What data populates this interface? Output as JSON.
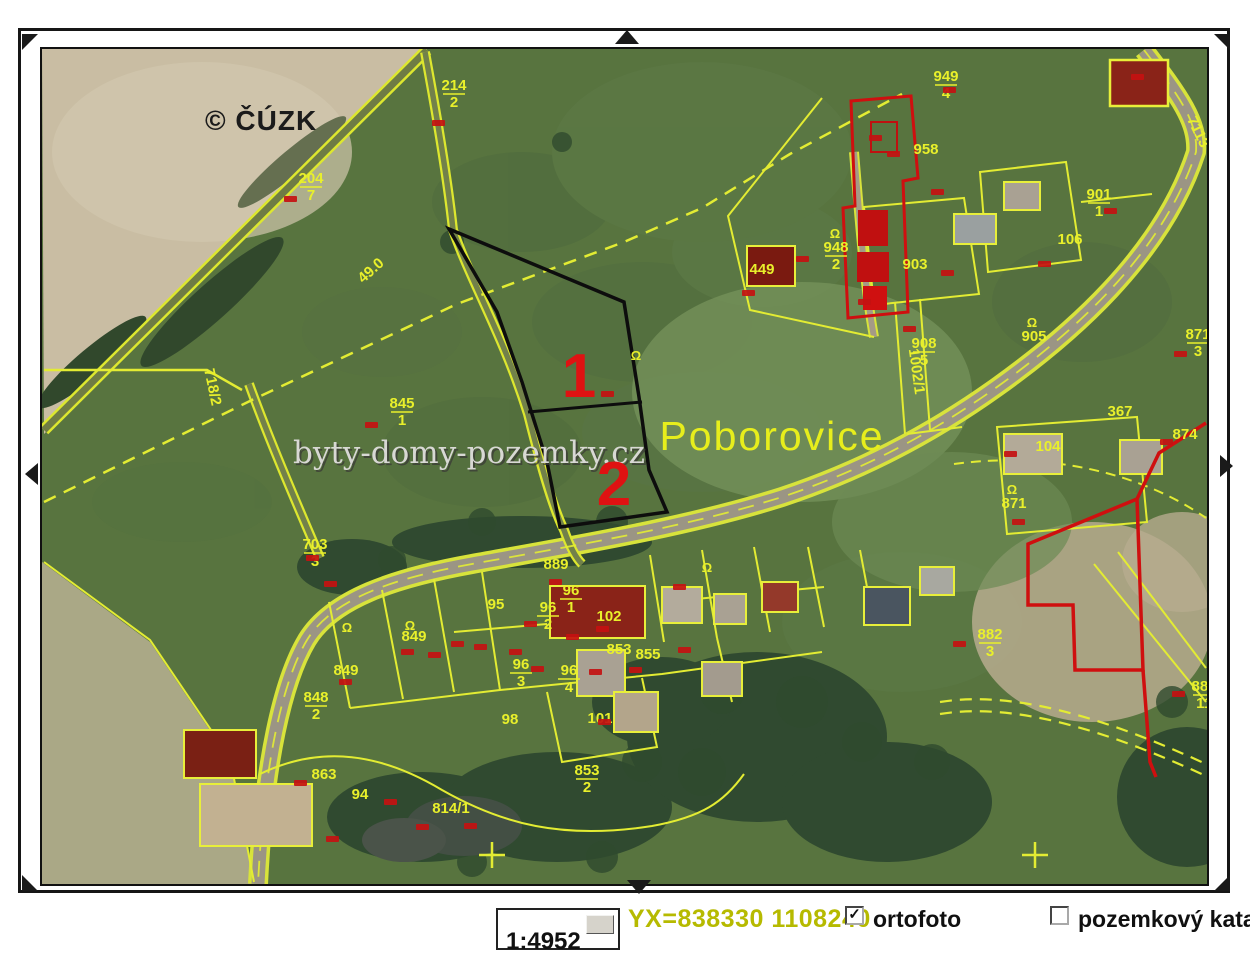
{
  "page": {
    "copyright": "© ČÚZK",
    "watermark": "byty-domy-pozemky.cz",
    "place_label": "Poborovice"
  },
  "icons": {
    "check": "✓"
  },
  "statusbar": {
    "scale_value": "1:4952",
    "coords_label": "YX=838330 1108240",
    "ortofoto": {
      "label": "ortofoto",
      "checked": true
    },
    "katastr": {
      "label": "pozemkový katastr",
      "checked": false
    }
  },
  "map": {
    "markers": [
      {
        "label": "1",
        "x": 577,
        "y": 395
      },
      {
        "label": "2",
        "x": 612,
        "y": 503
      }
    ],
    "labels": [
      {
        "text": "214",
        "den": "2",
        "x": 452,
        "y": 88
      },
      {
        "text": "204",
        "den": "7",
        "x": 309,
        "y": 181
      },
      {
        "text": "49.0",
        "x": 372,
        "y": 272,
        "rot": -42
      },
      {
        "text": "718/2",
        "x": 206,
        "y": 386,
        "rot": 78
      },
      {
        "text": "845",
        "den": "1",
        "x": 400,
        "y": 406
      },
      {
        "text": "949",
        "den": "4",
        "x": 944,
        "y": 79
      },
      {
        "text": "958",
        "x": 924,
        "y": 152
      },
      {
        "text": "948",
        "den": "2",
        "x": 834,
        "y": 250
      },
      {
        "text": "903",
        "x": 913,
        "y": 267
      },
      {
        "text": "901",
        "den": "1",
        "x": 1097,
        "y": 197
      },
      {
        "text": "106",
        "x": 1068,
        "y": 242
      },
      {
        "text": "449",
        "x": 760,
        "y": 272
      },
      {
        "text": "908",
        "den": "5",
        "x": 922,
        "y": 346
      },
      {
        "text": "905",
        "x": 1032,
        "y": 339
      },
      {
        "text": "1002/1",
        "x": 910,
        "y": 370,
        "rot": 82
      },
      {
        "text": "367",
        "x": 1118,
        "y": 414
      },
      {
        "text": "874",
        "x": 1183,
        "y": 437
      },
      {
        "text": "871",
        "den": "3",
        "x": 1196,
        "y": 337
      },
      {
        "text": "871",
        "x": 1012,
        "y": 506
      },
      {
        "text": "104",
        "x": 1046,
        "y": 449
      },
      {
        "text": "882",
        "den": "3",
        "x": 988,
        "y": 637
      },
      {
        "text": "880",
        "den": "11",
        "x": 1202,
        "y": 689
      },
      {
        "text": "703",
        "den": "3",
        "x": 313,
        "y": 547
      },
      {
        "text": "889",
        "x": 554,
        "y": 567
      },
      {
        "text": "95",
        "x": 494,
        "y": 607
      },
      {
        "text": "96",
        "den": "1",
        "x": 569,
        "y": 593
      },
      {
        "text": "96",
        "den": "2",
        "x": 546,
        "y": 610
      },
      {
        "text": "102",
        "x": 607,
        "y": 619
      },
      {
        "text": "849",
        "x": 412,
        "y": 639
      },
      {
        "text": "853",
        "x": 617,
        "y": 652
      },
      {
        "text": "855",
        "x": 646,
        "y": 657
      },
      {
        "text": "96",
        "den": "3",
        "x": 519,
        "y": 667
      },
      {
        "text": "96",
        "den": "4",
        "x": 567,
        "y": 673
      },
      {
        "text": "101",
        "x": 598,
        "y": 721
      },
      {
        "text": "98",
        "x": 508,
        "y": 722
      },
      {
        "text": "849",
        "x": 344,
        "y": 673
      },
      {
        "text": "848",
        "den": "2",
        "x": 314,
        "y": 700
      },
      {
        "text": "863",
        "x": 322,
        "y": 777
      },
      {
        "text": "94",
        "x": 358,
        "y": 797
      },
      {
        "text": "814/1",
        "x": 449,
        "y": 811
      },
      {
        "text": "853",
        "den": "2",
        "x": 585,
        "y": 773
      },
      {
        "text": "7113",
        "x": 1192,
        "y": 132,
        "rot": 64
      }
    ],
    "omega_symbols": [
      [
        833,
        236
      ],
      [
        1030,
        325
      ],
      [
        1010,
        492
      ],
      [
        634,
        358
      ],
      [
        408,
        628
      ],
      [
        345,
        630
      ],
      [
        705,
        570
      ]
    ],
    "red_marks": [
      [
        288,
        197
      ],
      [
        436,
        121
      ],
      [
        369,
        423
      ],
      [
        605,
        392
      ],
      [
        947,
        88
      ],
      [
        873,
        136
      ],
      [
        800,
        257
      ],
      [
        746,
        291
      ],
      [
        907,
        327
      ],
      [
        945,
        271
      ],
      [
        1108,
        209
      ],
      [
        1042,
        262
      ],
      [
        1164,
        440
      ],
      [
        1178,
        352
      ],
      [
        1008,
        452
      ],
      [
        1016,
        520
      ],
      [
        957,
        642
      ],
      [
        1176,
        692
      ],
      [
        328,
        582
      ],
      [
        405,
        650
      ],
      [
        432,
        653
      ],
      [
        455,
        642
      ],
      [
        478,
        645
      ],
      [
        513,
        650
      ],
      [
        535,
        667
      ],
      [
        570,
        635
      ],
      [
        600,
        627
      ],
      [
        593,
        670
      ],
      [
        633,
        668
      ],
      [
        553,
        580
      ],
      [
        528,
        622
      ],
      [
        602,
        720
      ],
      [
        343,
        680
      ],
      [
        677,
        585
      ],
      [
        682,
        648
      ],
      [
        330,
        837
      ],
      [
        420,
        825
      ],
      [
        298,
        781
      ],
      [
        388,
        800
      ],
      [
        468,
        824
      ],
      [
        310,
        556
      ],
      [
        862,
        300
      ],
      [
        935,
        190
      ],
      [
        1135,
        75
      ],
      [
        891,
        152
      ]
    ]
  }
}
